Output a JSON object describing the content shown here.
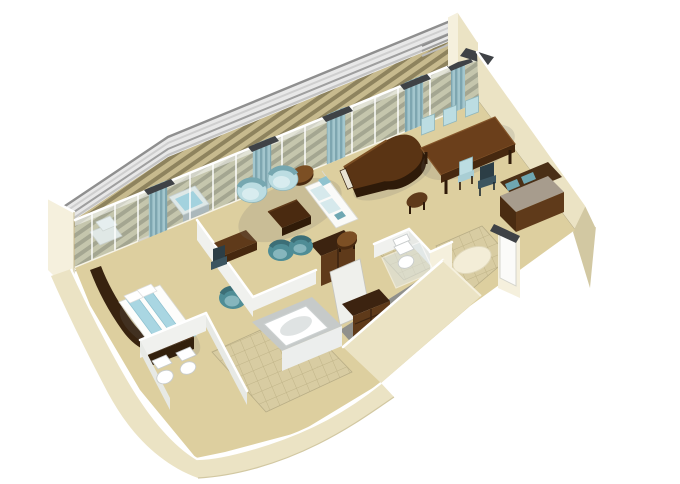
{
  "scene": {
    "title": "3D isometric cutaway floor plan of a penthouse suite",
    "type": "architectural-rendering",
    "background": "#ffffff",
    "rooms": [
      {
        "name": "balcony",
        "furniture": [
          "deck railing",
          "teak deck",
          "chaise lounge",
          "whirlpool tub"
        ]
      },
      {
        "name": "living-room",
        "furniture": [
          "grand piano",
          "sofa",
          "two armchairs",
          "coffee table",
          "round side table",
          "round stool"
        ]
      },
      {
        "name": "dining-area",
        "furniture": [
          "dining table",
          "six upholstered chairs",
          "dark chair",
          "sideboard"
        ]
      },
      {
        "name": "bedroom",
        "furniture": [
          "double bed",
          "curved headboard",
          "tv cabinet",
          "armchair",
          "pillows"
        ]
      },
      {
        "name": "bathroom",
        "furniture": [
          "bathtub",
          "tiled floor"
        ]
      },
      {
        "name": "wc",
        "furniture": [
          "toilet",
          "bidet"
        ]
      },
      {
        "name": "guest-wc",
        "furniture": [
          "toilet",
          "glass door"
        ]
      },
      {
        "name": "walk-in-closet",
        "furniture": [
          "wardrobe shelves",
          "cabinets",
          "stool"
        ]
      },
      {
        "name": "entry-foyer",
        "furniture": [
          "oval rug",
          "tiled floor",
          "entry door"
        ]
      },
      {
        "name": "office-nook",
        "furniture": [
          "desk",
          "desk chair",
          "two tub chairs",
          "open wardrobe"
        ]
      }
    ]
  },
  "palette": {
    "bg": "#ffffff",
    "floor": "#ddcf9f",
    "deck-base": "#c7ba8e",
    "deck-dark": "#8e835e",
    "tile-base": "#d8cca2",
    "tile-line": "#c0b488",
    "rug": "#f3edd7",
    "wall-cream": "#ebe3c4",
    "wall-cream-light": "#f5f0dd",
    "wall-cream-dark": "#d2c8a2",
    "wall-white": "#f2f2ee",
    "wall-cap-dark": "#3f4246",
    "glass": "#c3d6da",
    "mullion": "#ffffff",
    "curtain-a": "#a3c6cd",
    "curtain-b": "#7ea6b0",
    "wood": "#5f3a1a",
    "wood-dark": "#3c2310",
    "wood-light": "#7c4f24",
    "seat-blue": "#bcdde2",
    "seat-blue-dark": "#8fb6bc",
    "teal": "#4f8d96",
    "navy": "#2c3e46",
    "white-furn": "#fafaf8",
    "bed-blue": "#a9d6e2",
    "fixture": "#ffffff",
    "tub-surround": "#c6cac9",
    "tub-face": "#eceeed",
    "hot-tub": "#8ccfe2",
    "sideboard-top": "#a79c8d"
  }
}
